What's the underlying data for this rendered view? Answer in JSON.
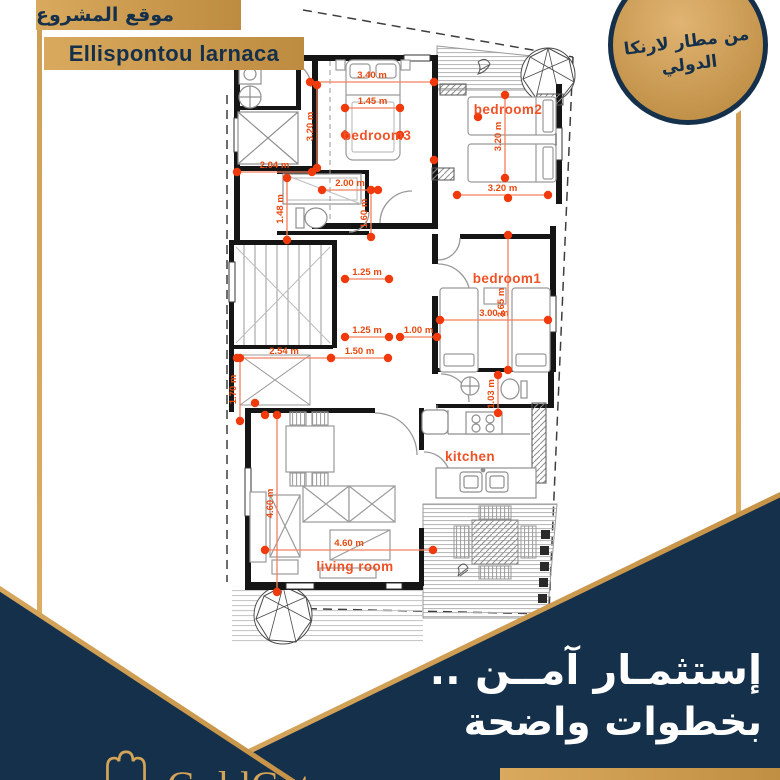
{
  "colors": {
    "navy": "#15304b",
    "gold": "#c9984f",
    "gold_light": "#d9a95e",
    "gold_dark": "#bd8c40",
    "dot": "#f13a0c",
    "dim_line": "#f5805e",
    "dim_text": "#e8490f",
    "room_label": "#ef5226",
    "wall": "#151515"
  },
  "header": {
    "location_ar": "موقع المشروع",
    "location_en": "Ellispontou larnaca"
  },
  "badge": {
    "line1": "من مطار لارنكا",
    "line2": "الدولي"
  },
  "footer": {
    "headline_line1": "إستثمـار آمــن ..",
    "headline_line2": "بخطوات واضحة",
    "brand": "GoldGate"
  },
  "floorplan": {
    "rooms": [
      {
        "label": "bedroom3",
        "x": 377,
        "y": 140
      },
      {
        "label": "bedroom2",
        "x": 508,
        "y": 114
      },
      {
        "label": "bedroom1",
        "x": 507,
        "y": 283
      },
      {
        "label": "kitchen",
        "x": 470,
        "y": 461
      },
      {
        "label": "living room",
        "x": 355,
        "y": 571
      }
    ],
    "dimensions": [
      {
        "label": "3.40 m",
        "x1": 310,
        "y1": 82,
        "x2": 434,
        "y2": 82
      },
      {
        "label": "1.45 m",
        "x1": 345,
        "y1": 108,
        "x2": 400,
        "y2": 108
      },
      {
        "label": "3.20 m",
        "x1": 317,
        "y1": 85,
        "x2": 317,
        "y2": 168
      },
      {
        "label": "2.04 m",
        "x1": 237,
        "y1": 172,
        "x2": 312,
        "y2": 172
      },
      {
        "label": "1.48 m",
        "x1": 287,
        "y1": 178,
        "x2": 287,
        "y2": 240
      },
      {
        "label": "2.00 m",
        "x1": 322,
        "y1": 190,
        "x2": 378,
        "y2": 190
      },
      {
        "label": "1.60 m",
        "x1": 371,
        "y1": 190,
        "x2": 371,
        "y2": 237
      },
      {
        "label": "3.20 m",
        "x1": 505,
        "y1": 95,
        "x2": 505,
        "y2": 178
      },
      {
        "label": "3.20 m",
        "x1": 457,
        "y1": 195,
        "x2": 548,
        "y2": 195
      },
      {
        "label": "1.25 m",
        "x1": 345,
        "y1": 279,
        "x2": 389,
        "y2": 279
      },
      {
        "label": "1.25 m",
        "x1": 345,
        "y1": 337,
        "x2": 389,
        "y2": 337
      },
      {
        "label": "1.00 m",
        "x1": 400,
        "y1": 337,
        "x2": 437,
        "y2": 337
      },
      {
        "label": "3.00 m",
        "x1": 440,
        "y1": 320,
        "x2": 548,
        "y2": 320
      },
      {
        "label": "3.65 m",
        "x1": 508,
        "y1": 235,
        "x2": 508,
        "y2": 370
      },
      {
        "label": "2.54 m",
        "x1": 237,
        "y1": 358,
        "x2": 331,
        "y2": 358
      },
      {
        "label": "1.50 m",
        "x1": 331,
        "y1": 358,
        "x2": 388,
        "y2": 358
      },
      {
        "label": "1.70 m",
        "x1": 240,
        "y1": 358,
        "x2": 240,
        "y2": 421
      },
      {
        "label": "1.03 m",
        "x1": 498,
        "y1": 375,
        "x2": 498,
        "y2": 413
      },
      {
        "label": "4.60 m",
        "x1": 265,
        "y1": 550,
        "x2": 433,
        "y2": 550
      },
      {
        "label": "4.60 m",
        "x1": 277,
        "y1": 415,
        "x2": 277,
        "y2": 592
      }
    ],
    "extra_dots": [
      [
        281,
        62
      ],
      [
        434,
        160
      ],
      [
        478,
        117
      ],
      [
        345,
        135
      ],
      [
        400,
        135
      ],
      [
        508,
        198
      ],
      [
        265,
        415
      ],
      [
        255,
        403
      ]
    ]
  }
}
